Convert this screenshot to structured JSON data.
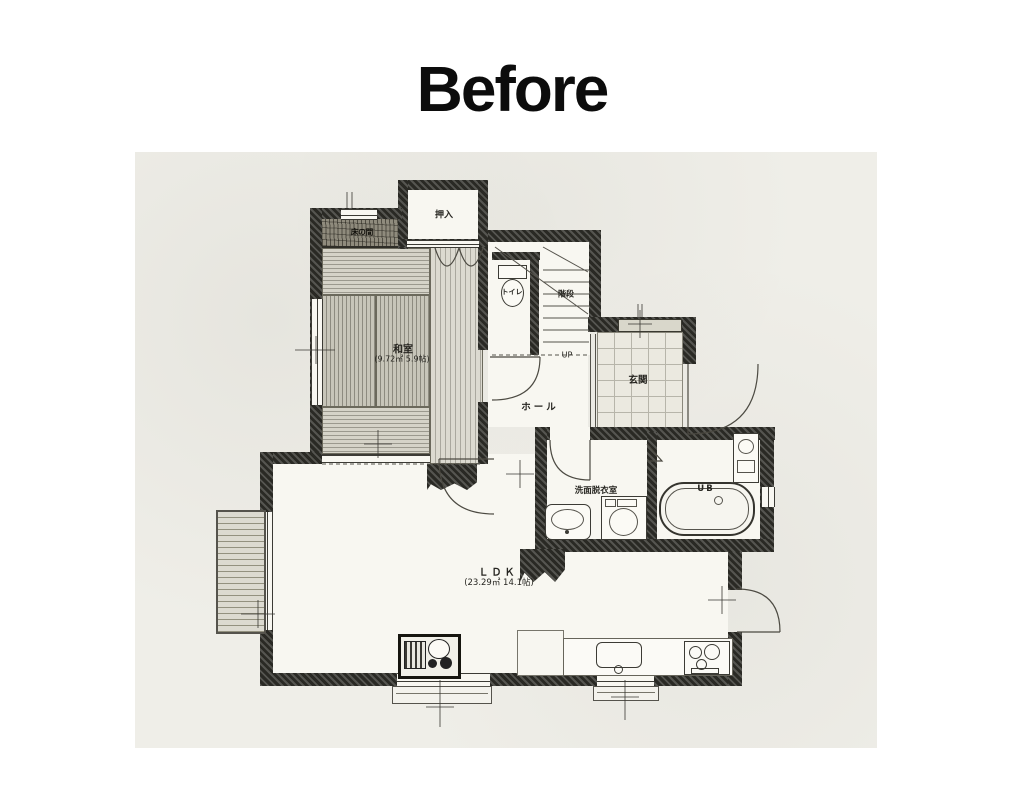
{
  "page": {
    "title": "Before"
  },
  "colors": {
    "paper": "#efeee8",
    "ink": "#35342e",
    "title": "#0c0c0c",
    "tatami": "#c7c5b9"
  },
  "rooms": {
    "oshiire": {
      "label": "押入"
    },
    "tokonoma": {
      "label": "床の間"
    },
    "washitsu": {
      "label": "和室",
      "area": "(9.72㎡ 5.9帖)"
    },
    "toilet": {
      "label": "トイレ"
    },
    "stairs": {
      "label": "階段",
      "up": "UP"
    },
    "genkan": {
      "label": "玄関"
    },
    "hall": {
      "label": "ホール"
    },
    "laundry": {
      "label": "洗面脱衣室"
    },
    "bath": {
      "label": "UB"
    },
    "ldk": {
      "label": "ＬＤＫ",
      "area": "(23.29㎡ 14.1帖)"
    }
  }
}
